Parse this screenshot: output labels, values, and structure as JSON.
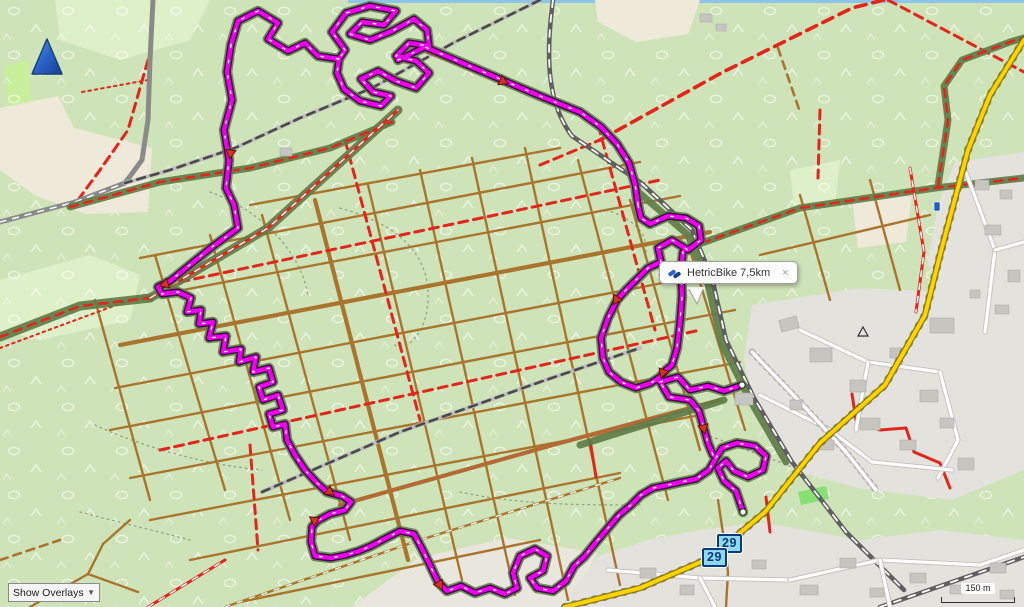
{
  "colors": {
    "route": "#ee00ee",
    "route-casing": "#3b0b42",
    "trail-green": "#5e7d48",
    "track-brown": "#a9752e",
    "path-red": "#e3251c",
    "road-yellow": "#ffd400",
    "forest-bg": "#cfe3b8",
    "meadow": "#def0c8",
    "cream": "#efe9da",
    "urban": "#e3e2dd",
    "building": "#c6c5c0",
    "railway": "#5f5f5f",
    "water": "#8ec4e8",
    "badge-bg": "#8fd8ef",
    "badge-border": "#0a3b78"
  },
  "tooltip": {
    "label": "HetricBike 7,5km",
    "close": "×"
  },
  "badges": [
    {
      "label": "29"
    },
    {
      "label": "29"
    }
  ],
  "scale_bar": {
    "label": "150 m"
  },
  "controls": {
    "overlay_select": "Show Overlays"
  }
}
